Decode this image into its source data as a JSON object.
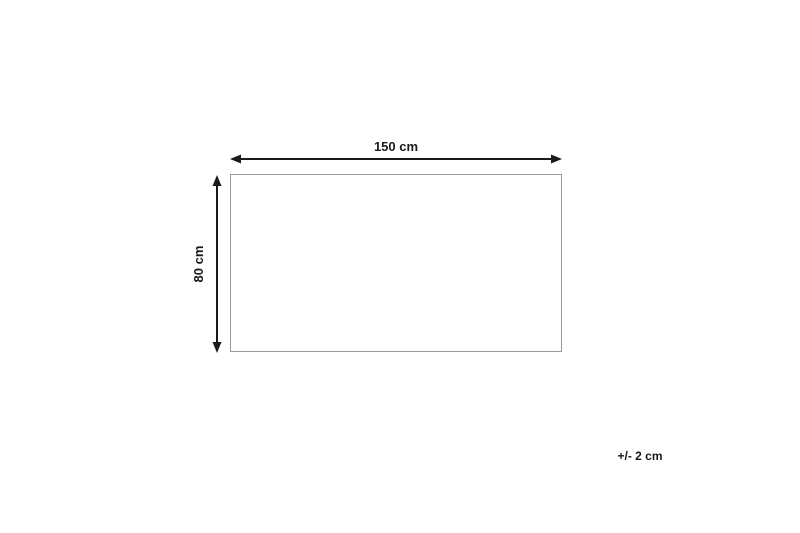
{
  "diagram": {
    "type": "product-dimension-diagram",
    "shape": {
      "kind": "rectangle",
      "width_cm": 150,
      "height_cm": 80
    },
    "width_label": "150 cm",
    "height_label": "80 cm",
    "tolerance_label": "+/- 2 cm"
  },
  "colors": {
    "background": "#ffffff",
    "arrow": "#1a1a1a",
    "text": "#1a1a1a",
    "shape_border": "#999999"
  }
}
